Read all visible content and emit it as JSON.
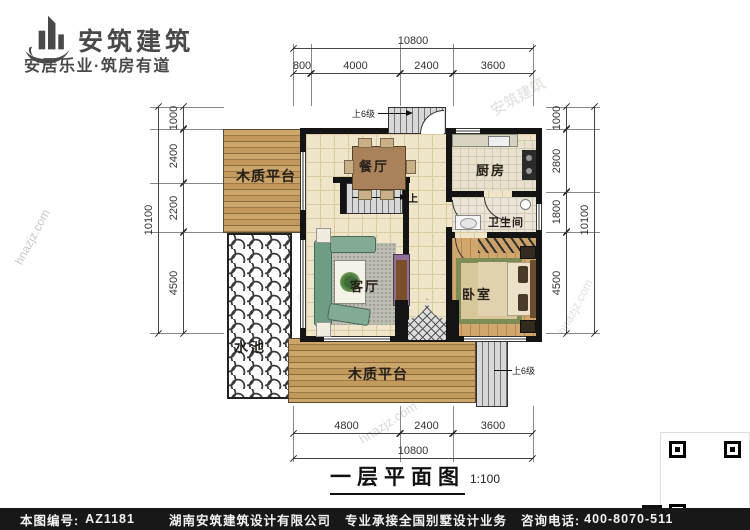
{
  "brand": {
    "name": "安筑建筑",
    "tagline": "安居乐业·筑房有道"
  },
  "plan": {
    "rooms": {
      "dining": "餐厅",
      "kitchen": "厨房",
      "bathroom": "卫生间",
      "living": "客厅",
      "bedroom": "卧室",
      "deck_top": "木质平台",
      "deck_bottom": "木质平台",
      "pool": "水池"
    },
    "annotations": {
      "entry_steps_top": "上6级",
      "entry_steps_side": "上6级",
      "stairs_up": "上"
    }
  },
  "dimensions": {
    "top": {
      "total": "10800",
      "segments": [
        "800",
        "4000",
        "2400",
        "3600"
      ]
    },
    "bottom": {
      "total": "10800",
      "segments": [
        "4800",
        "2400",
        "3600"
      ]
    },
    "left": {
      "total": "10100",
      "segments": [
        "1000",
        "2400",
        "2200",
        "4500"
      ]
    },
    "right": {
      "total": "10100",
      "segments": [
        "1000",
        "2800",
        "1800",
        "4500"
      ]
    }
  },
  "title": {
    "text": "一层平面图",
    "scale": "1:100"
  },
  "watermark": {
    "brand": "安筑建筑",
    "site": "hnazjz.com"
  },
  "footer": {
    "plan_no_label": "本图编号:",
    "plan_no": "AZ1181",
    "company": "湖南安筑建筑设计有限公司",
    "service": "专业承接全国别墅设计业务",
    "phone_label": "咨询电话:",
    "phone": "400-8070-511",
    "qr_label": "网"
  }
}
